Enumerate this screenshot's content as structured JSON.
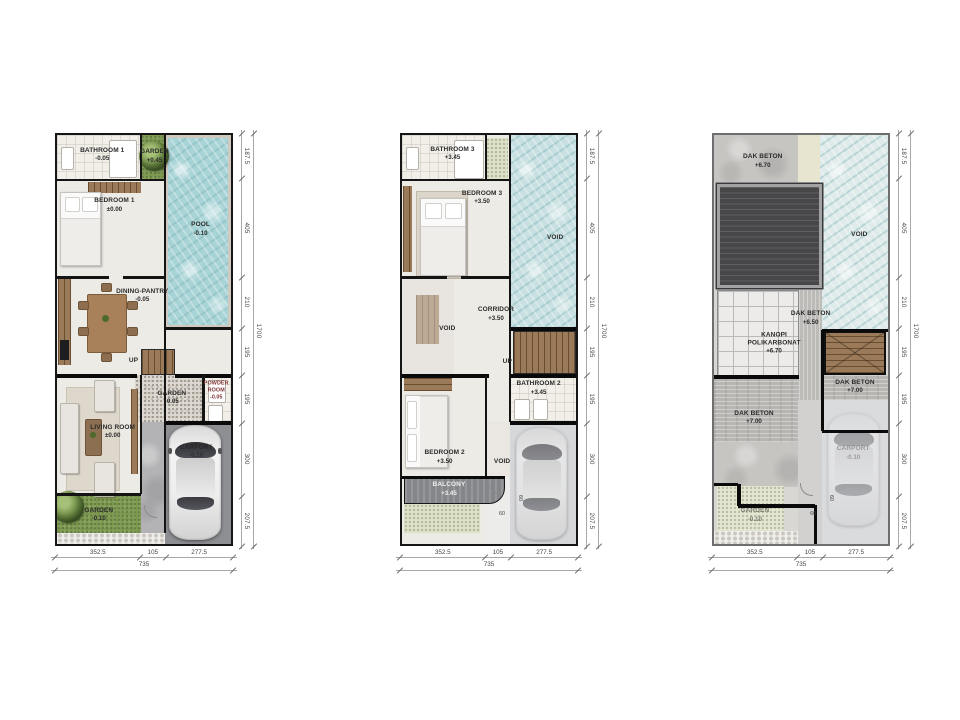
{
  "plans": [
    {
      "id": "ground-floor",
      "rooms": {
        "bathroom1": {
          "label": "BATHROOM 1",
          "level": "-0.05"
        },
        "garden_top": {
          "label": "GARDEN",
          "level": "+0.45"
        },
        "bedroom1": {
          "label": "BEDROOM 1",
          "level": "±0.00"
        },
        "pool": {
          "label": "POOL",
          "level": "-0.10"
        },
        "dining": {
          "label": "DINING-PANTRY",
          "level": "-0.05"
        },
        "up": "UP",
        "garden_mid": {
          "label": "GARDEN",
          "level": "-0.05"
        },
        "powder": {
          "label": "POWDER ROOM",
          "level": "-0.05"
        },
        "living": {
          "label": "LIVING ROOM",
          "level": "±0.00"
        },
        "carport": {
          "label": "CARPORT",
          "level": "-0.10"
        },
        "garden_bottom": {
          "label": "GARDEN",
          "level": "-0.10"
        }
      },
      "dims": {
        "bottom": [
          "352.5",
          "105",
          "277.5"
        ],
        "bottom_total": "735",
        "right": [
          "187.5",
          "405",
          "210",
          "195",
          "195",
          "300",
          "207.5"
        ],
        "right_total": "1700"
      }
    },
    {
      "id": "second-floor",
      "rooms": {
        "bathroom3": {
          "label": "BATHROOM 3",
          "level": "+3.45"
        },
        "bedroom3": {
          "label": "BEDROOM 3",
          "level": "+3.50"
        },
        "void_right": "VOID",
        "corridor": {
          "label": "CORRIDOR",
          "level": "+3.50"
        },
        "void_left": "VOID",
        "up": "UP",
        "bathroom2": {
          "label": "BATHROOM 2",
          "level": "+3.45"
        },
        "bedroom2": {
          "label": "BEDROOM 2",
          "level": "+3.50"
        },
        "void_bottom": "VOID",
        "balcony": {
          "label": "BALCONY",
          "level": "+3.45"
        }
      },
      "dims": {
        "bottom": [
          "352.5",
          "105",
          "277.5"
        ],
        "bottom_total": "735",
        "right": [
          "187.5",
          "405",
          "210",
          "195",
          "195",
          "300",
          "207.5"
        ],
        "right_total": "1700",
        "door": "60"
      }
    },
    {
      "id": "roof-plan",
      "rooms": {
        "dak_top": {
          "label": "DAK BETON",
          "level": "+6.70"
        },
        "void": "VOID",
        "dak_mid": {
          "label": "DAK BETON",
          "level": "+6.50"
        },
        "kanopi": {
          "label": "KANOPI POLIKARBONAT",
          "level": "+6.70"
        },
        "dak_right": {
          "label": "DAK BETON",
          "level": "+7.00"
        },
        "dak_left": {
          "label": "DAK BETON",
          "level": "+7.00"
        },
        "garden": {
          "label": "GARDEN",
          "level": "-0.10"
        },
        "carport": {
          "label": "CARPORT",
          "level": "-0.10"
        }
      },
      "dims": {
        "bottom": [
          "352.5",
          "105",
          "277.5"
        ],
        "bottom_total": "735",
        "right": [
          "187.5",
          "405",
          "210",
          "195",
          "195",
          "300",
          "207.5"
        ],
        "right_total": "1700",
        "door": "60"
      }
    }
  ]
}
